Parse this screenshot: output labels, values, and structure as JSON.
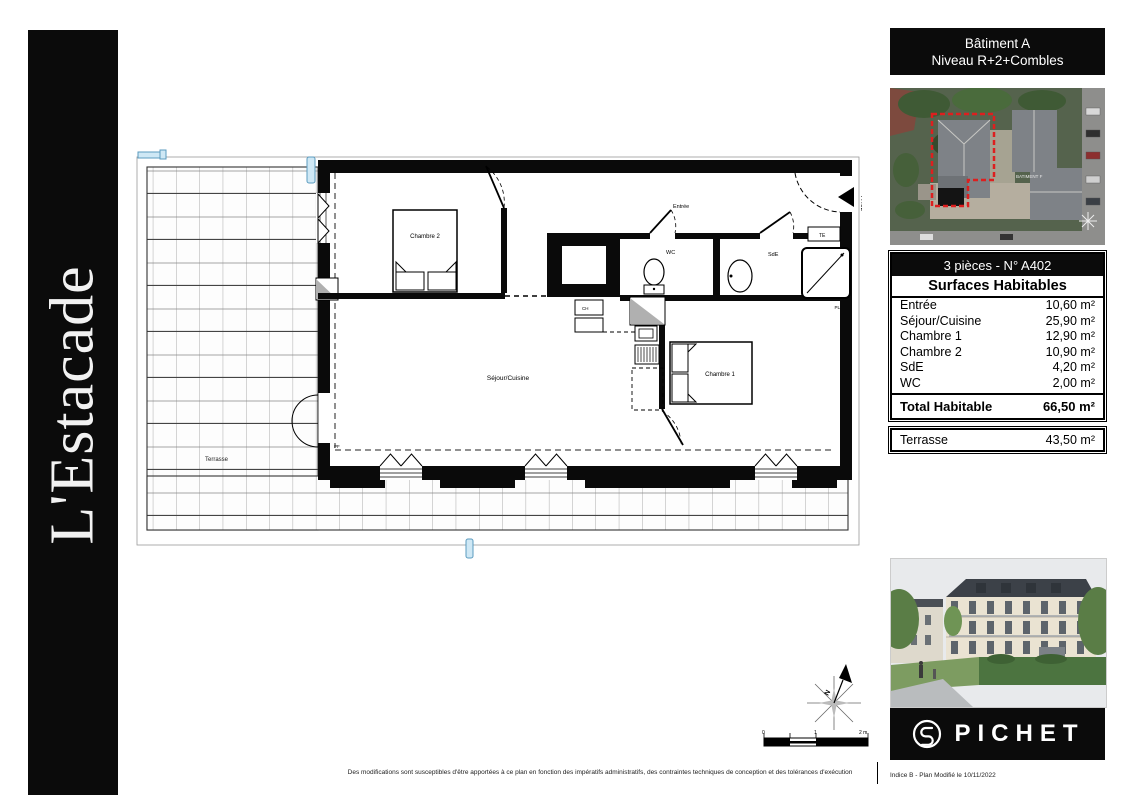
{
  "banner": {
    "title": "L'Estacade"
  },
  "sidebar": {
    "header_line1": "Bâtiment A",
    "header_line2": "Niveau R+2+Combles",
    "aerial_building_label": "BATIMENT F",
    "unit_title": "3 pièces - N° A402",
    "surfaces_title": "Surfaces Habitables",
    "rows": [
      {
        "label": "Entrée",
        "value": "10,60 m²"
      },
      {
        "label": "Séjour/Cuisine",
        "value": "25,90 m²"
      },
      {
        "label": "Chambre 1",
        "value": "12,90 m²"
      },
      {
        "label": "Chambre 2",
        "value": "10,90 m²"
      },
      {
        "label": "SdE",
        "value": "4,20 m²"
      },
      {
        "label": "WC",
        "value": "2,00 m²"
      }
    ],
    "total_label": "Total Habitable",
    "total_value": "66,50 m²",
    "terrace_label": "Terrasse",
    "terrace_value": "43,50 m²",
    "logo_text": "PICHET",
    "revision": "Indice B - Plan Modifié le 10/11/2022"
  },
  "plan": {
    "labels": {
      "chambre2": "Chambre 2",
      "chambre1": "Chambre 1",
      "sejour": "Séjour/Cuisine",
      "wc": "WC",
      "sde": "SdE",
      "entree": "Entrée",
      "terrasse": "Terrasse",
      "te": "TE",
      "ch": "CH",
      "pf": "PF",
      "pl": "PL",
      "unit_ref": "A402"
    },
    "compass_north": "N",
    "scale_ticks": {
      "t0": "0",
      "t1": "1",
      "t2": "2 m"
    }
  },
  "footer": {
    "disclaimer": "Des modifications sont susceptibles d'être apportées à ce plan en fonction des impératifs administratifs, des contraintes techniques de conception et des tolérances d'exécution"
  }
}
